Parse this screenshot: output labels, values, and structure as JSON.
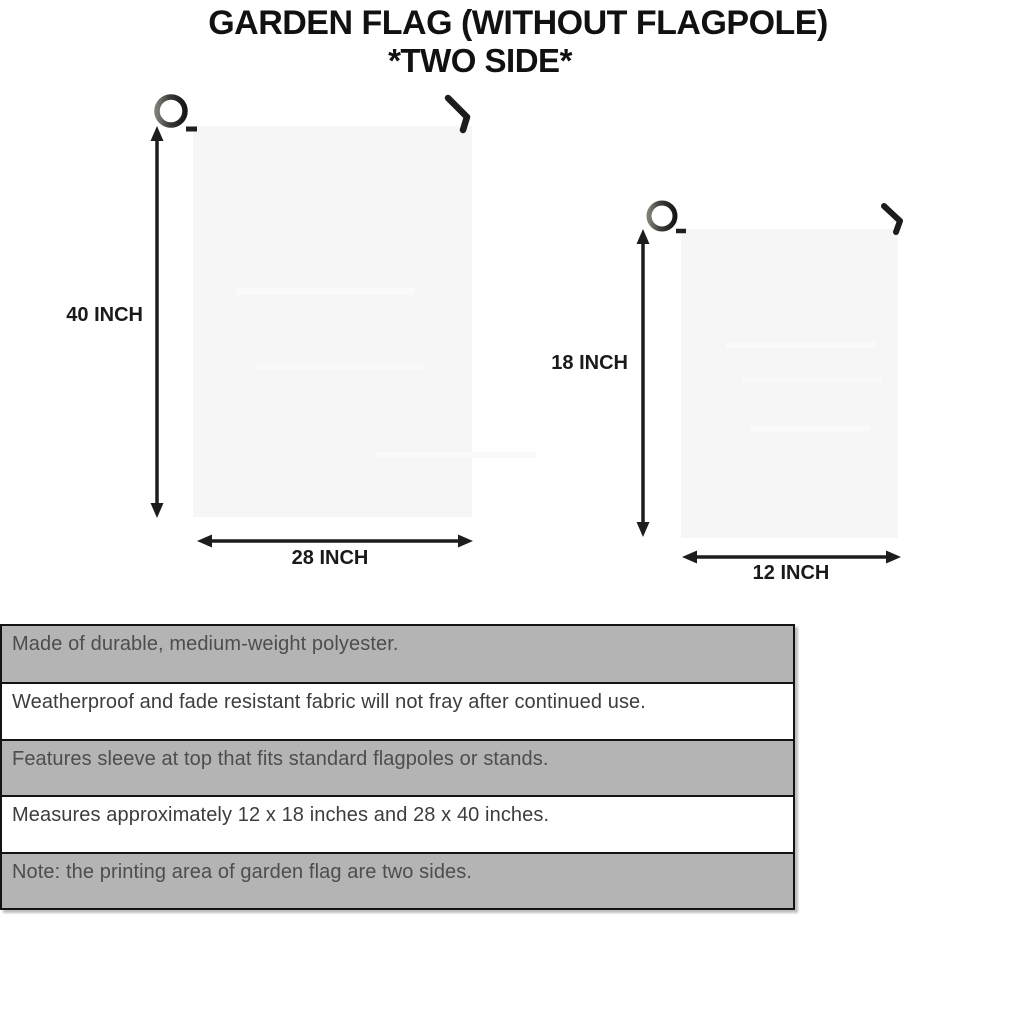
{
  "title": {
    "line1": "GARDEN FLAG (WITHOUT FLAGPOLE)",
    "line2": "*TWO SIDE*"
  },
  "flags": {
    "large": {
      "height_label": "40 INCH",
      "width_label": "28 INCH"
    },
    "small": {
      "height_label": "18 INCH",
      "width_label": "12 INCH"
    }
  },
  "features": [
    {
      "text": "Made of durable, medium-weight polyester.",
      "shaded": true
    },
    {
      "text": "Weatherproof and fade resistant fabric will not fray after continued use.",
      "shaded": false
    },
    {
      "text": "Features sleeve at top that fits standard flagpoles or stands.",
      "shaded": true
    },
    {
      "text": "Measures approximately 12 x 18 inches and 28 x 40 inches.",
      "shaded": false
    },
    {
      "text": "Note: the printing area of garden flag are two sides.",
      "shaded": true
    }
  ],
  "colors": {
    "flag_fill": "#f6f6f6",
    "pole": "#3b3b38",
    "hook": "#1c1c1c",
    "arrow": "#1d1d1d",
    "table_row_shaded": "#b4b4b4",
    "table_row_plain": "#ffffff",
    "table_border": "#141414",
    "title_text": "#111111"
  }
}
